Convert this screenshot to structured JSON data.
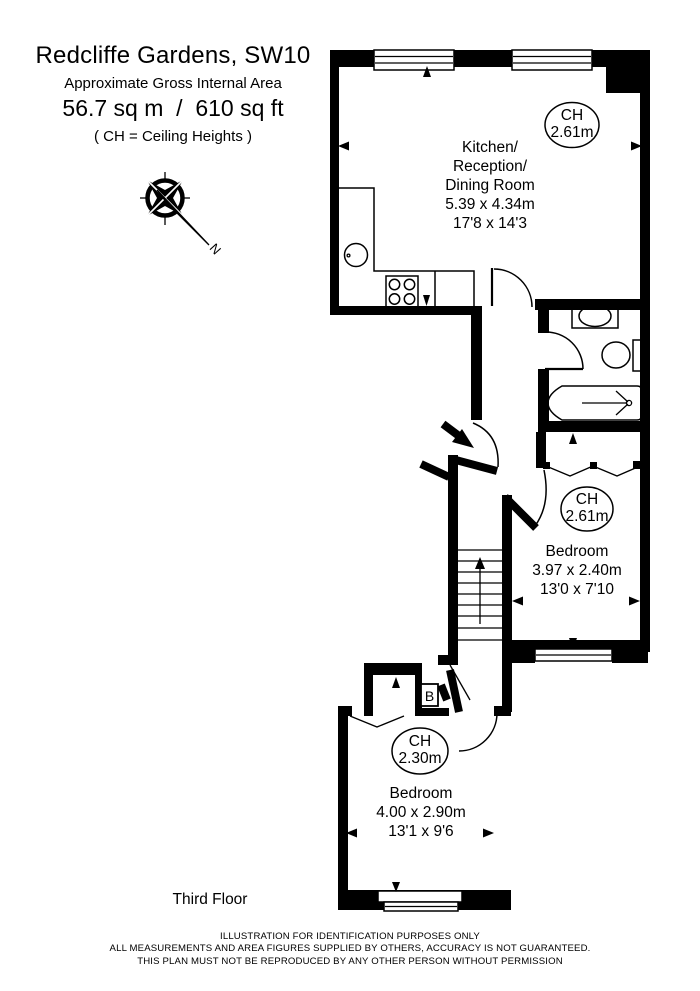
{
  "header": {
    "title": "Redcliffe Gardens, SW10",
    "subtitle": "Approximate Gross Internal Area",
    "area": "56.7 sq m  /  610 sq ft",
    "ch_note": "( CH = Ceiling Heights )"
  },
  "compass": {
    "north_label": "N"
  },
  "rooms": {
    "kitchen": {
      "name_line1": "Kitchen/",
      "name_line2": "Reception/",
      "name_line3": "Dining Room",
      "dims_metric": "5.39 x 4.34m",
      "dims_imperial": "17'8 x 14'3",
      "ch_label": "CH",
      "ch_value": "2.61m"
    },
    "bedroom1": {
      "name": "Bedroom",
      "dims_metric": "3.97 x 2.40m",
      "dims_imperial": "13'0 x 7'10",
      "ch_label": "CH",
      "ch_value": "2.61m"
    },
    "bedroom2": {
      "name": "Bedroom",
      "dims_metric": "4.00 x 2.90m",
      "dims_imperial": "13'1 x 9'6",
      "ch_label": "CH",
      "ch_value": "2.30m"
    }
  },
  "labels": {
    "boiler": "B",
    "floor": "Third Floor"
  },
  "footer": {
    "line1": "ILLUSTRATION FOR IDENTIFICATION PURPOSES ONLY",
    "line2": "ALL MEASUREMENTS AND AREA FIGURES SUPPLIED BY OTHERS, ACCURACY IS NOT GUARANTEED.",
    "line3": "THIS PLAN MUST NOT BE REPRODUCED BY ANY OTHER PERSON WITHOUT PERMISSION"
  },
  "icons": {
    "compass": "compass-rose-with-north-needle",
    "sink": "round-kitchen-sink",
    "stove": "four-burner-hob",
    "basin": "bathroom-basin",
    "toilet": "toilet-with-cistern",
    "bathtub": "bath-with-shower",
    "stairs": "staircase-up-arrow",
    "markers": "measurement-arrow-triangles"
  },
  "colors": {
    "ink": "#000000",
    "background": "#ffffff"
  }
}
